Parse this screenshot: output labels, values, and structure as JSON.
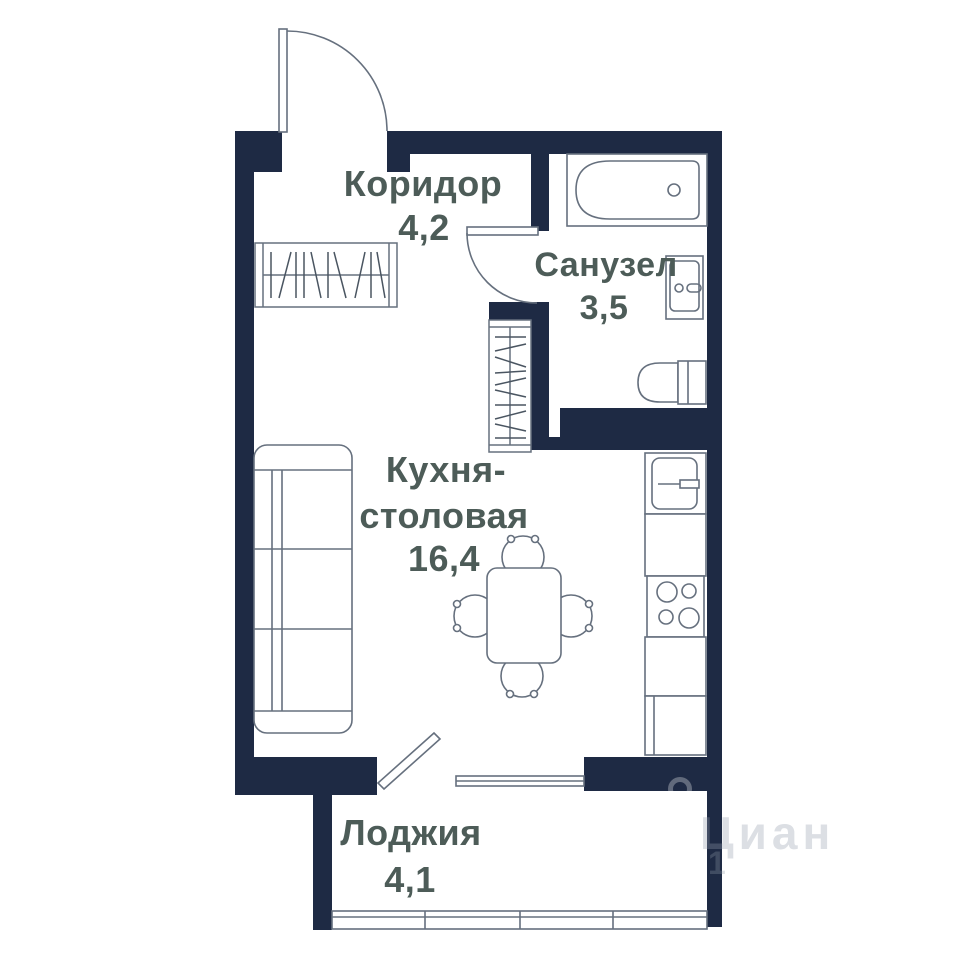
{
  "rooms": {
    "corridor": {
      "name": "Коридор",
      "area": "4,2"
    },
    "bathroom": {
      "name": "Санузел",
      "area": "3,5"
    },
    "kitchen": {
      "name_line1": "Кухня-",
      "name_line2": "столовая",
      "area": "16,4"
    },
    "loggia": {
      "name": "Лоджия",
      "area": "4,1"
    }
  },
  "watermark": {
    "brand": "Циан",
    "extra": "1"
  },
  "colors": {
    "wall": "#1e2a44",
    "outline": "#66707e",
    "hatch": "#4a5561",
    "label": "#4d5c58",
    "background": "#ffffff"
  }
}
